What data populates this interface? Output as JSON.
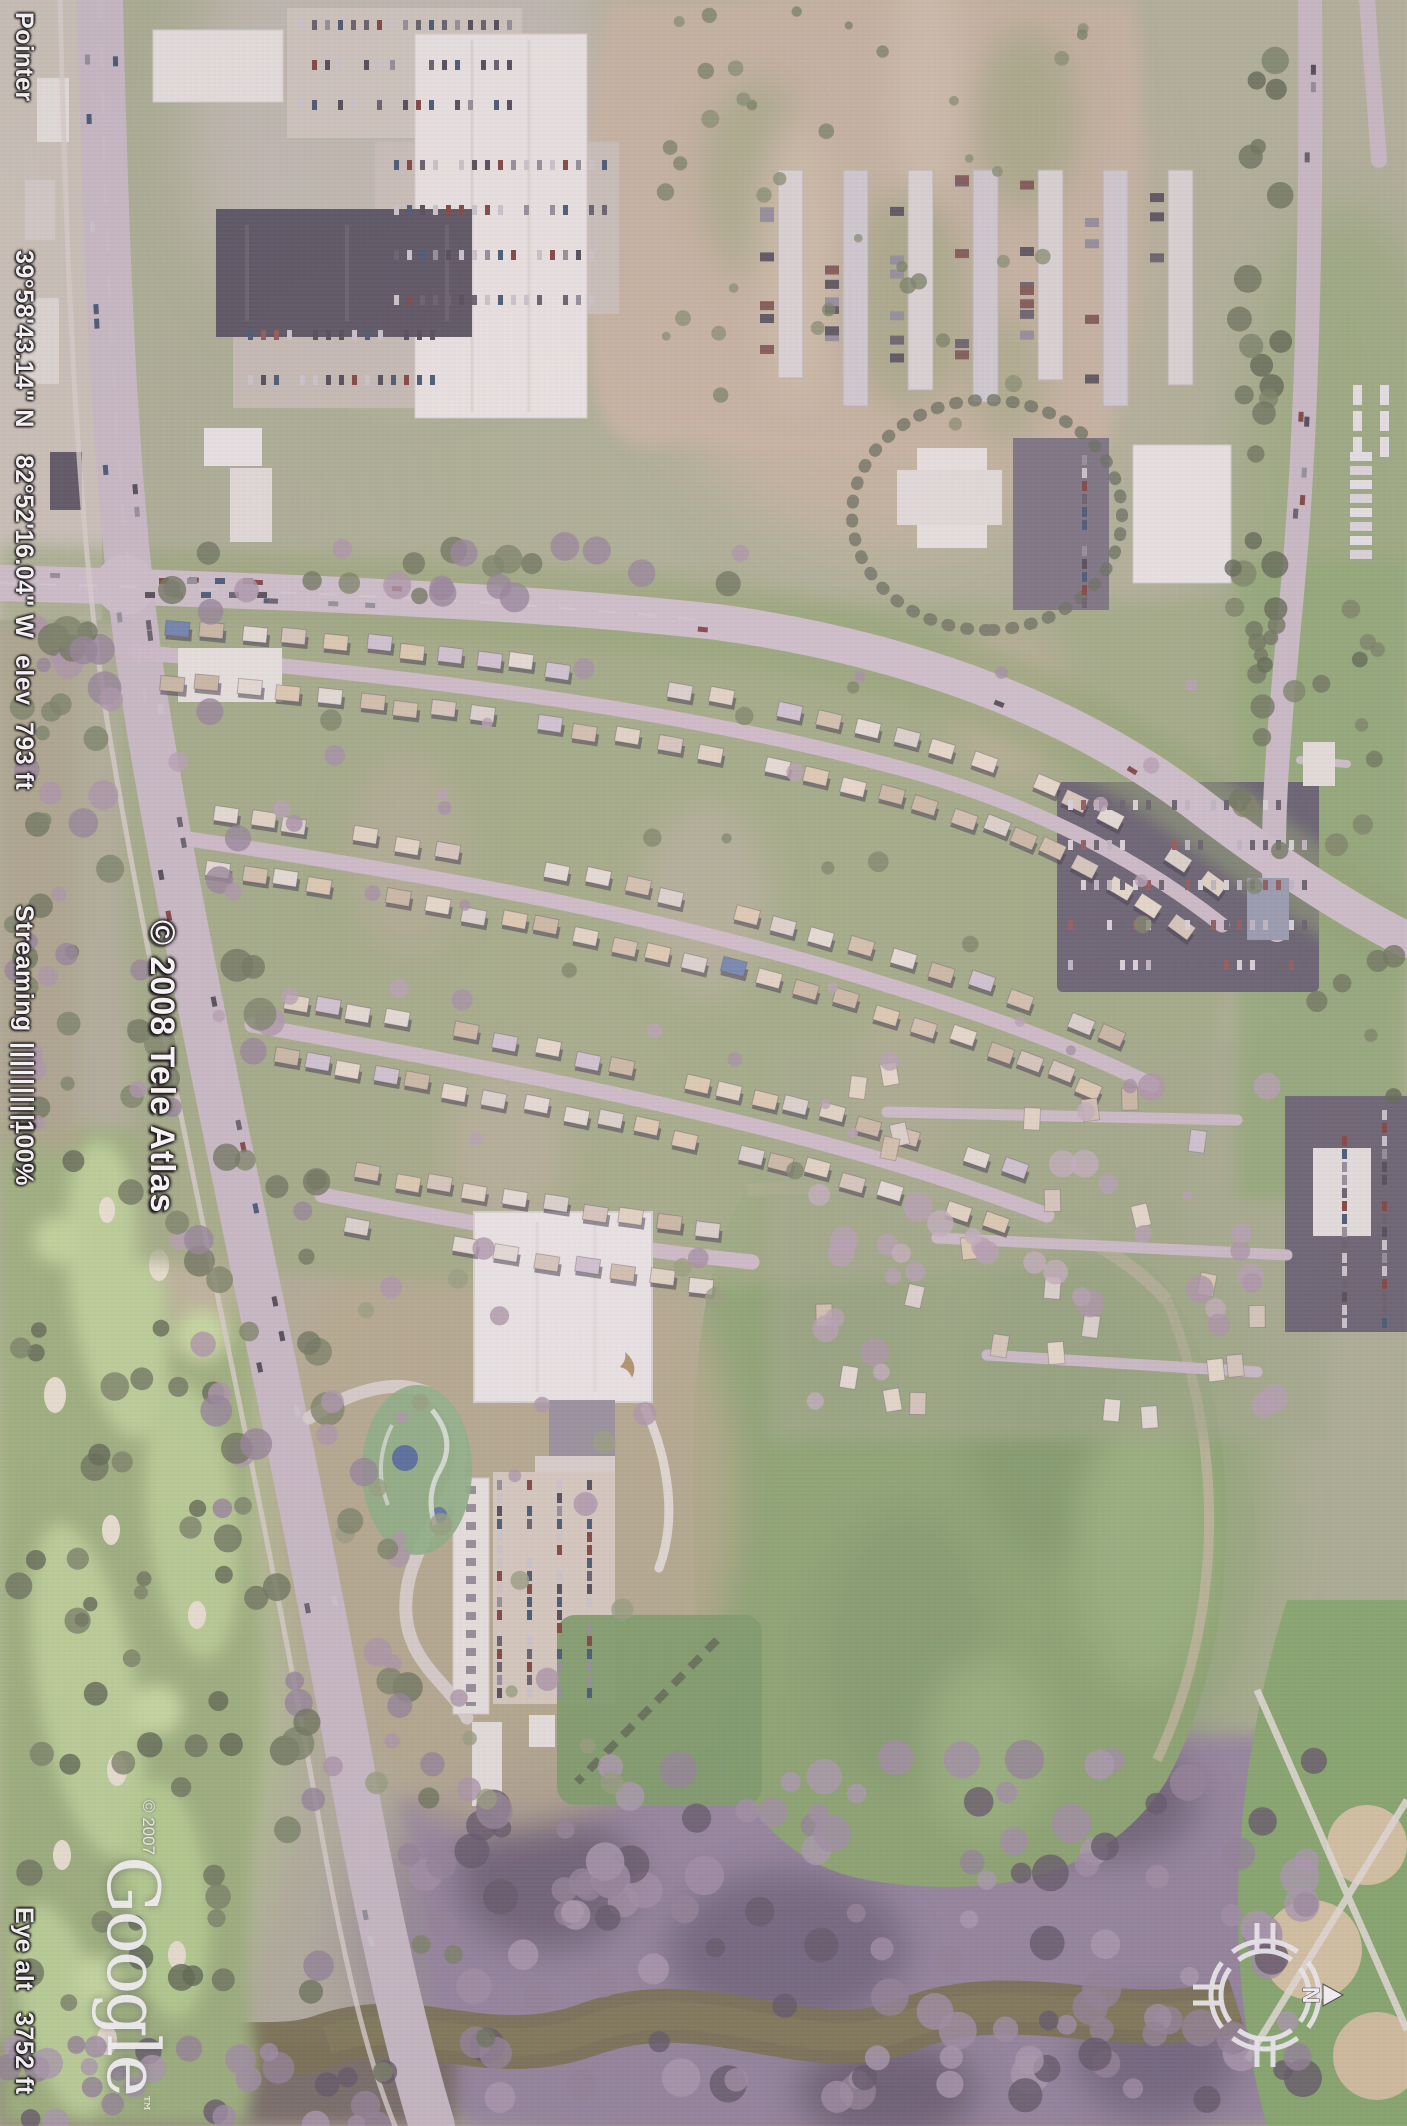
{
  "app": {
    "title": "Google Earth aerial view (rotated scan)"
  },
  "status_bar": {
    "pointer_label": "Pointer",
    "pointer_lat": "39°58'43.14\" N",
    "pointer_lon": "82°52'16.04\" W",
    "elev_label": "elev",
    "elev_value": "793 ft",
    "streaming_label": "Streaming",
    "streaming_bars": "||||||||||",
    "streaming_value": "100%",
    "eye_alt_label": "Eye alt",
    "eye_alt_value": "3752 ft"
  },
  "watermarks": {
    "map_copyright": "© 2008 Tele Atlas",
    "imagery_copyright": "© 2007",
    "logo_text": "Google",
    "logo_tm": "™"
  },
  "compass": {
    "north_label": "N"
  },
  "palette": {
    "status_text": "#fdfdfd",
    "status_outline": "#000000",
    "compass_white": "#f2f0f4",
    "grass_green": "#8aa569",
    "golf_green": "#b6d488",
    "dirt_tan": "#c7b397",
    "road_pink_gray": "#c7b9c4",
    "roof_white": "#ecebe8",
    "roof_dark": "#474553",
    "woodland_mauve": "#8f7d9b",
    "river_olive": "#6f673f"
  }
}
